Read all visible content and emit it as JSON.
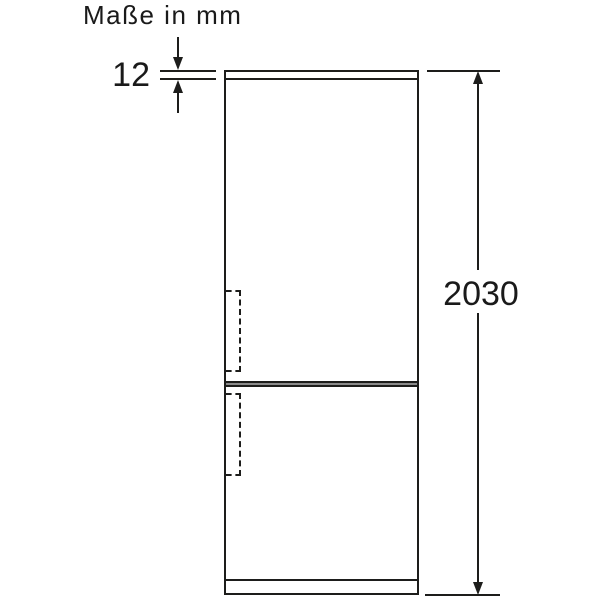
{
  "title": "Maße in mm",
  "dimensions": {
    "top_thickness": "12",
    "total_height": "2030"
  },
  "drawing": {
    "type": "product-dimension-diagram",
    "subject": "fridge-freezer-front-view",
    "unit": "mm"
  },
  "colors": {
    "line": "#1d1d1b",
    "divider_fill": "#8a8a8a",
    "text": "#1a1a1a",
    "background": "#ffffff"
  }
}
